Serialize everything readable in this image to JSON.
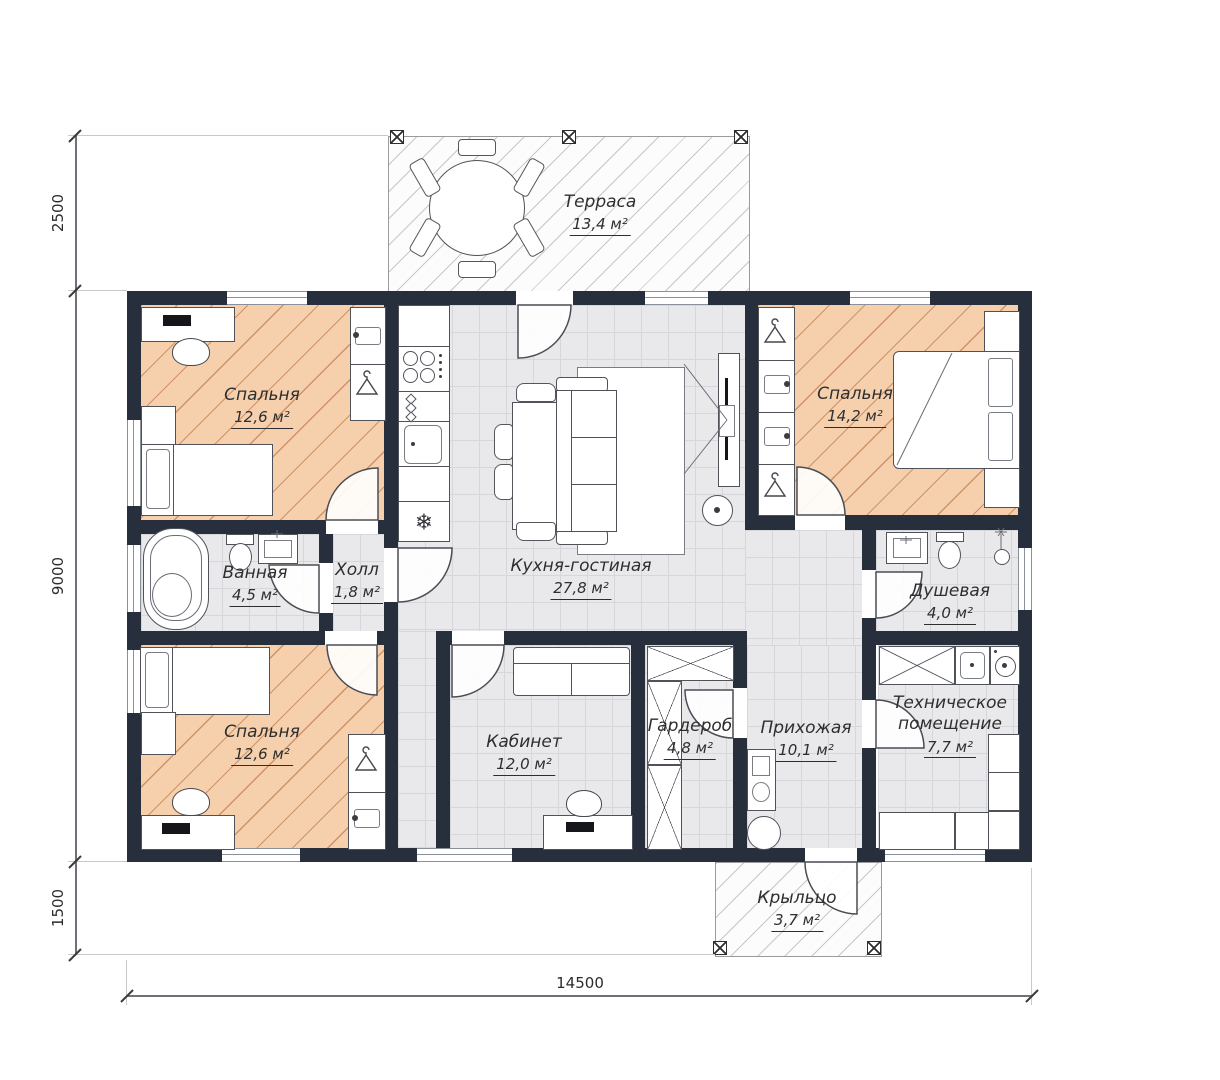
{
  "rooms": {
    "terrace": {
      "name": "Терраса",
      "area": "13,4 м²"
    },
    "bedroom_tl": {
      "name": "Спальня",
      "area": "12,6 м²"
    },
    "bedroom_tr": {
      "name": "Спальня",
      "area": "14,2 м²"
    },
    "bathroom": {
      "name": "Ванная",
      "area": "4,5 м²"
    },
    "hall": {
      "name": "Холл",
      "area": "1,8 м²"
    },
    "kitchen_living": {
      "name": "Кухня-гостиная",
      "area": "27,8 м²"
    },
    "shower": {
      "name": "Душевая",
      "area": "4,0 м²"
    },
    "bedroom_bl": {
      "name": "Спальня",
      "area": "12,6 м²"
    },
    "office": {
      "name": "Кабинет",
      "area": "12,0 м²"
    },
    "wardrobe": {
      "name": "Гардероб",
      "area": "4,8 м²"
    },
    "entry": {
      "name": "Прихожая",
      "area": "10,1 м²"
    },
    "tech": {
      "name": "Техническое помещение",
      "area": "7,7 м²"
    },
    "porch": {
      "name": "Крыльцо",
      "area": "3,7 м²"
    }
  },
  "dimensions": {
    "terrace_depth": "2500",
    "house_depth": "9000",
    "porch_depth": "1500",
    "house_width": "14500"
  },
  "icons": {
    "fridge": "❄"
  },
  "colors": {
    "wall": "#272e3c",
    "bedroom_floor": "#f6d0ad",
    "bedroom_hatch": "#cf9266",
    "tile_floor": "#e9e9eb",
    "tile_line": "#d6d7da"
  }
}
